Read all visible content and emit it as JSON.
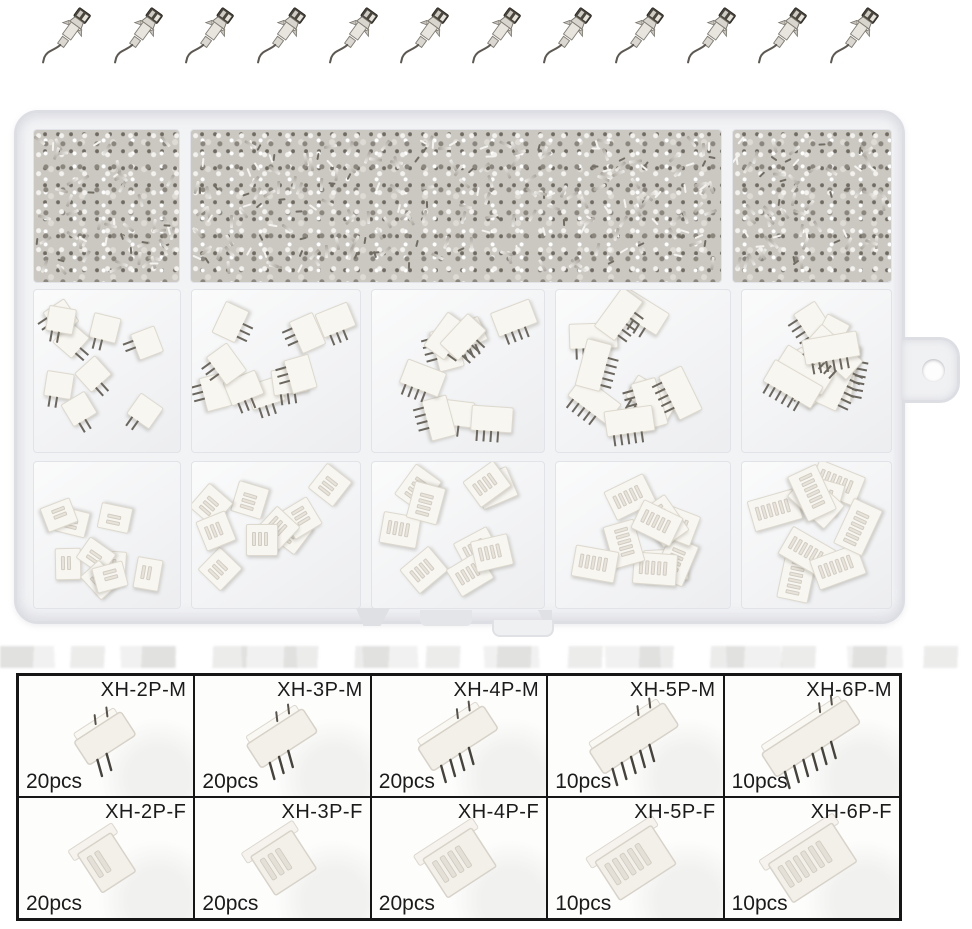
{
  "product": {
    "kind": "connector assortment kit product photo"
  },
  "loose_terminals_row": {
    "icon": "crimp-terminal-icon",
    "count": 12
  },
  "storage_box": {
    "name": "clear-plastic-organizer-box",
    "top_strip": {
      "compartments": 3,
      "contents": "loose-metal-crimp-terminals"
    },
    "middle_row": {
      "compartments": 5,
      "contents": "male-pin-headers",
      "pins_per_compartment": [
        2,
        3,
        4,
        5,
        6
      ]
    },
    "bottom_row": {
      "compartments": 5,
      "contents": "female-housings",
      "pins_per_compartment": [
        2,
        3,
        4,
        5,
        6
      ]
    }
  },
  "colors": {
    "background": "#ffffff",
    "metal_light": "#efede9",
    "metal_mid": "#b3afa7",
    "metal_dark": "#6f6b63",
    "box_plastic": "#f2f3f5",
    "box_edge": "#dddee4",
    "connector_white": "#f6f3ed",
    "connector_edge": "#d8d3c9",
    "pin_dark": "#46433c",
    "table_border": "#161616",
    "text": "#1b1b1b"
  },
  "spec_table": {
    "rows": [
      {
        "cells": [
          {
            "label": "XH-2P-M",
            "count": "20pcs",
            "pins": 2,
            "gender": "male"
          },
          {
            "label": "XH-3P-M",
            "count": "20pcs",
            "pins": 3,
            "gender": "male"
          },
          {
            "label": "XH-4P-M",
            "count": "20pcs",
            "pins": 4,
            "gender": "male"
          },
          {
            "label": "XH-5P-M",
            "count": "10pcs",
            "pins": 5,
            "gender": "male"
          },
          {
            "label": "XH-6P-M",
            "count": "10pcs",
            "pins": 6,
            "gender": "male"
          }
        ]
      },
      {
        "cells": [
          {
            "label": "XH-2P-F",
            "count": "20pcs",
            "pins": 2,
            "gender": "female"
          },
          {
            "label": "XH-3P-F",
            "count": "20pcs",
            "pins": 3,
            "gender": "female"
          },
          {
            "label": "XH-4P-F",
            "count": "20pcs",
            "pins": 4,
            "gender": "female"
          },
          {
            "label": "XH-5P-F",
            "count": "10pcs",
            "pins": 5,
            "gender": "female"
          },
          {
            "label": "XH-6P-F",
            "count": "10pcs",
            "pins": 6,
            "gender": "female"
          }
        ]
      }
    ]
  }
}
